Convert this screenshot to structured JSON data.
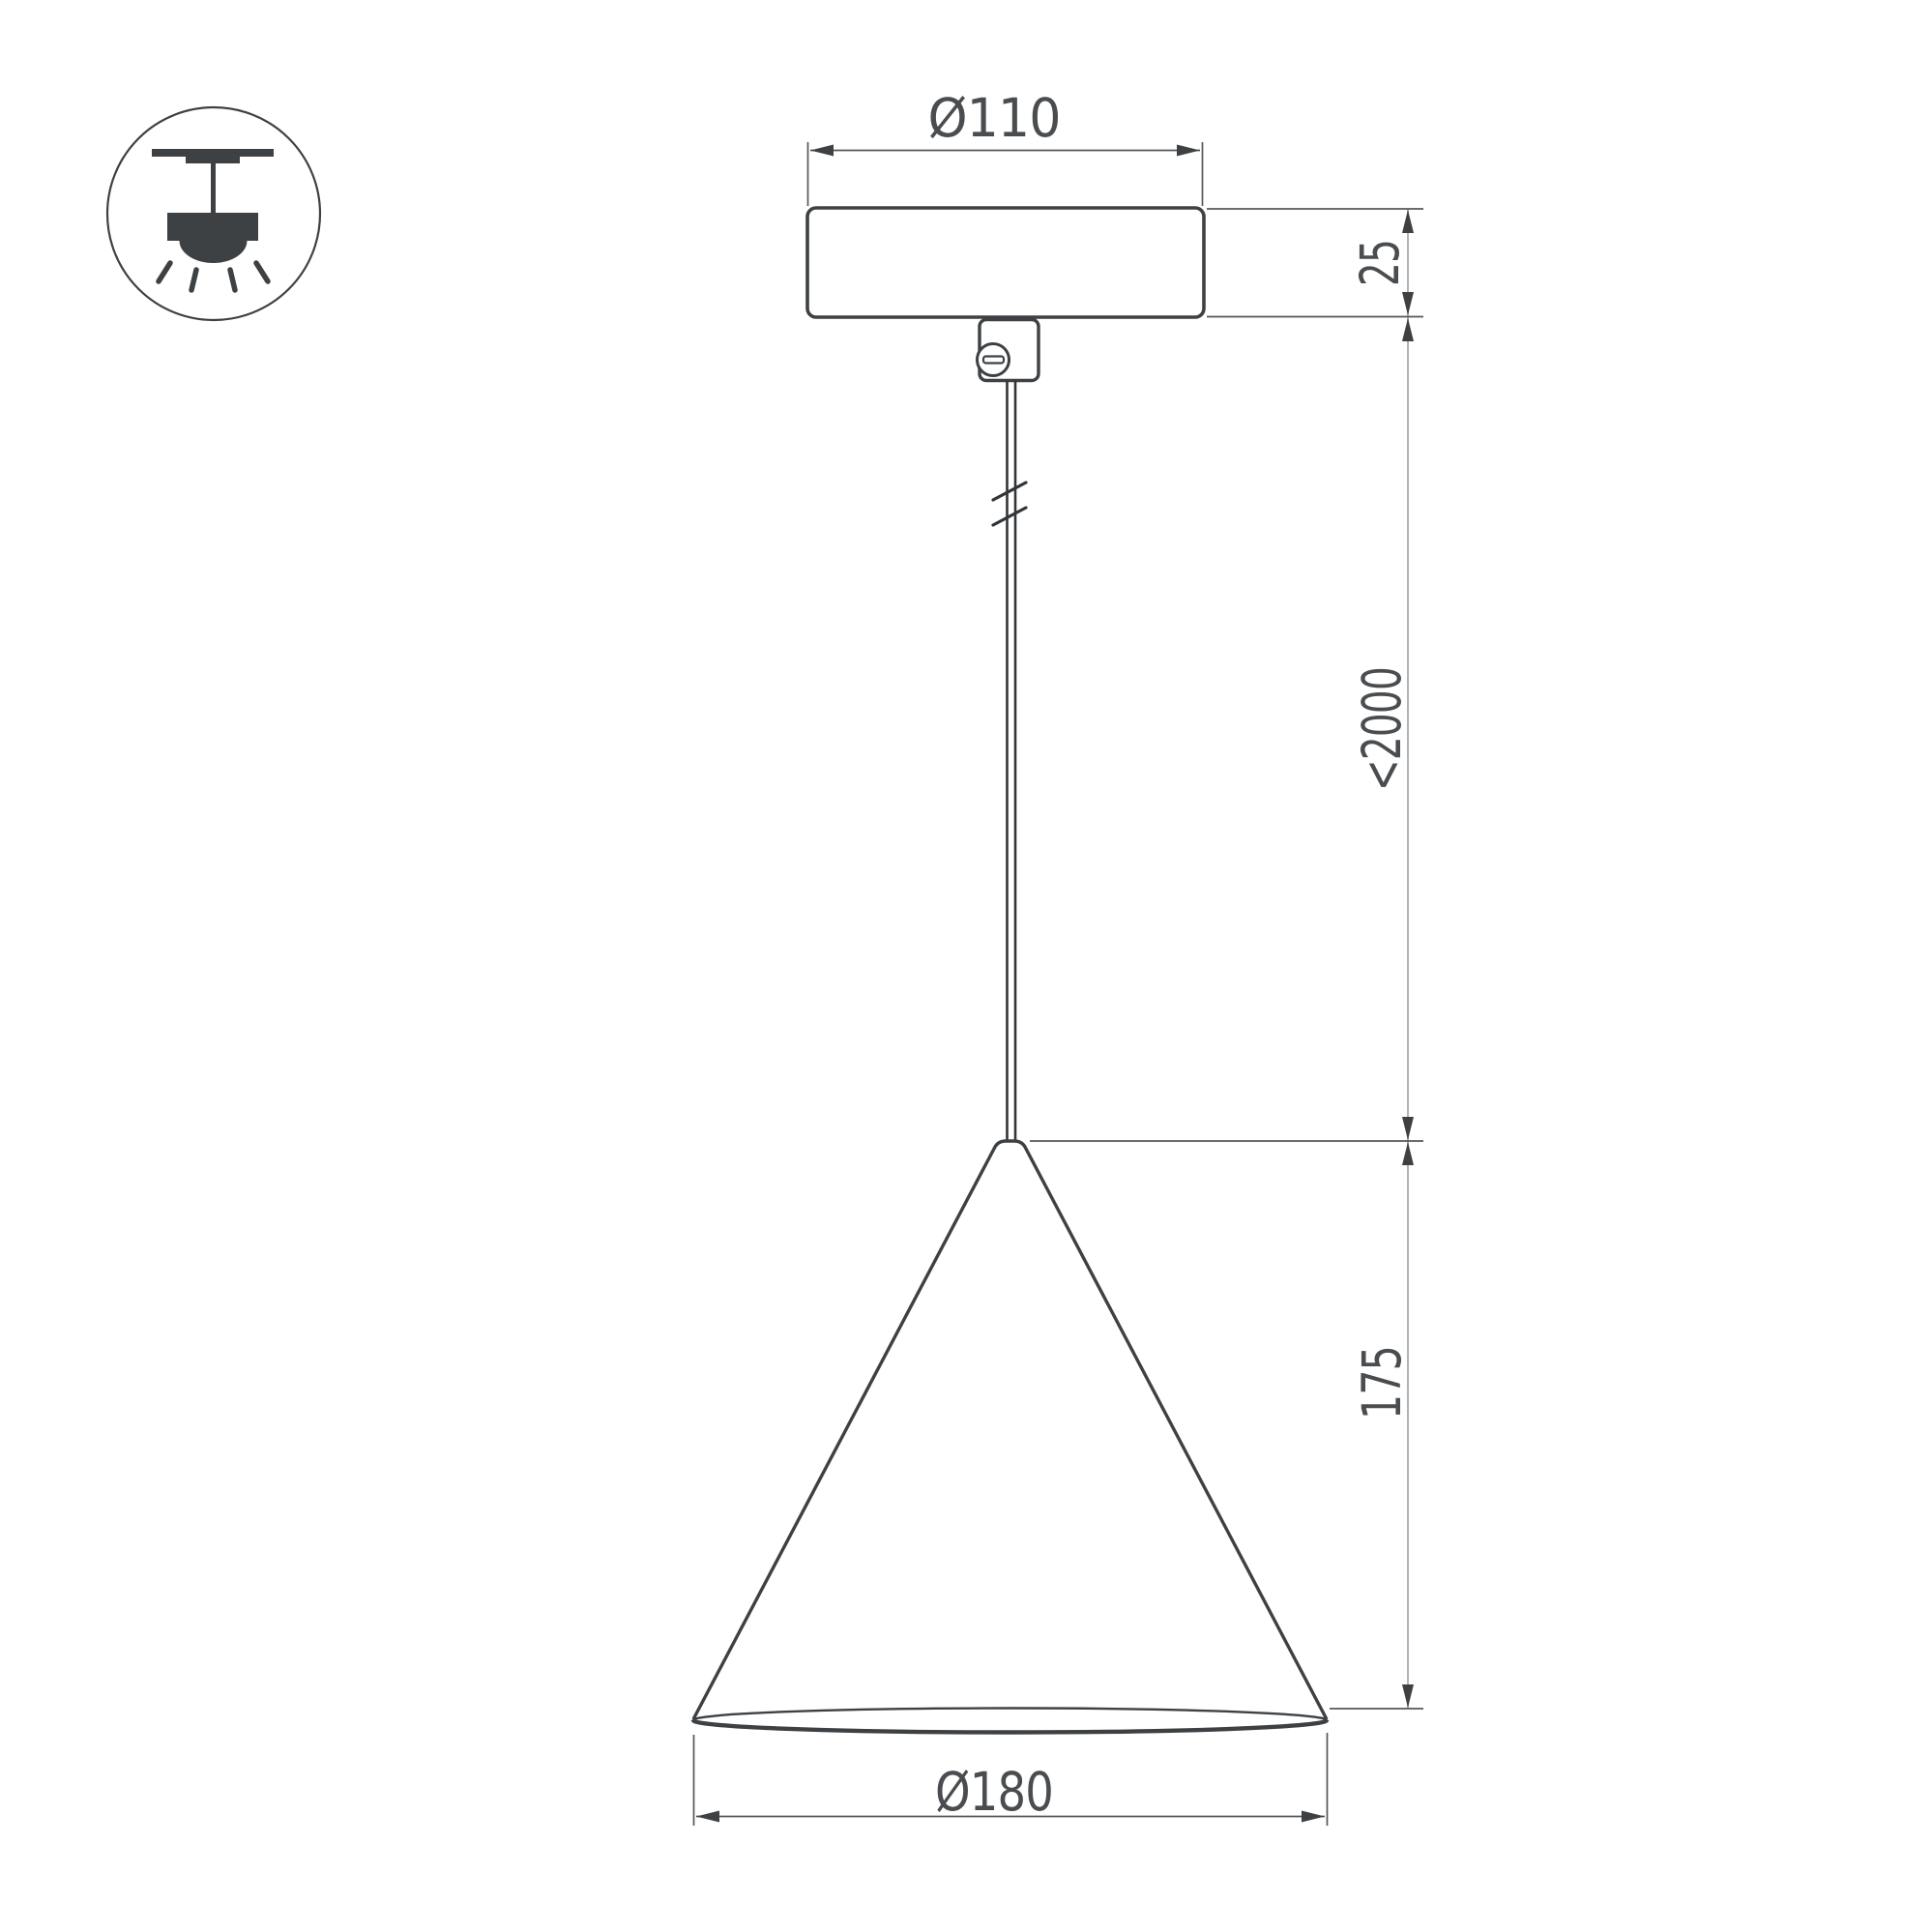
{
  "drawing": {
    "type": "technical-dimension-drawing",
    "subject": "cone pendant lamp with ceiling canopy and suspension cable",
    "dimensions": {
      "canopy_diameter": "Ø110",
      "canopy_height": "25",
      "max_suspension_length": "<2000",
      "shade_height": "175",
      "shade_diameter": "Ø180"
    },
    "icon": {
      "name": "pendant-ceiling-mount-icon",
      "meaning": "suspended ceiling luminaire, light directed downward"
    },
    "colors": {
      "object_line": "#3e4144",
      "dimension_line": "#54575a",
      "long_dimension_line": "#b1b4b6",
      "text": "#4a4d50",
      "background": "#ffffff"
    }
  }
}
